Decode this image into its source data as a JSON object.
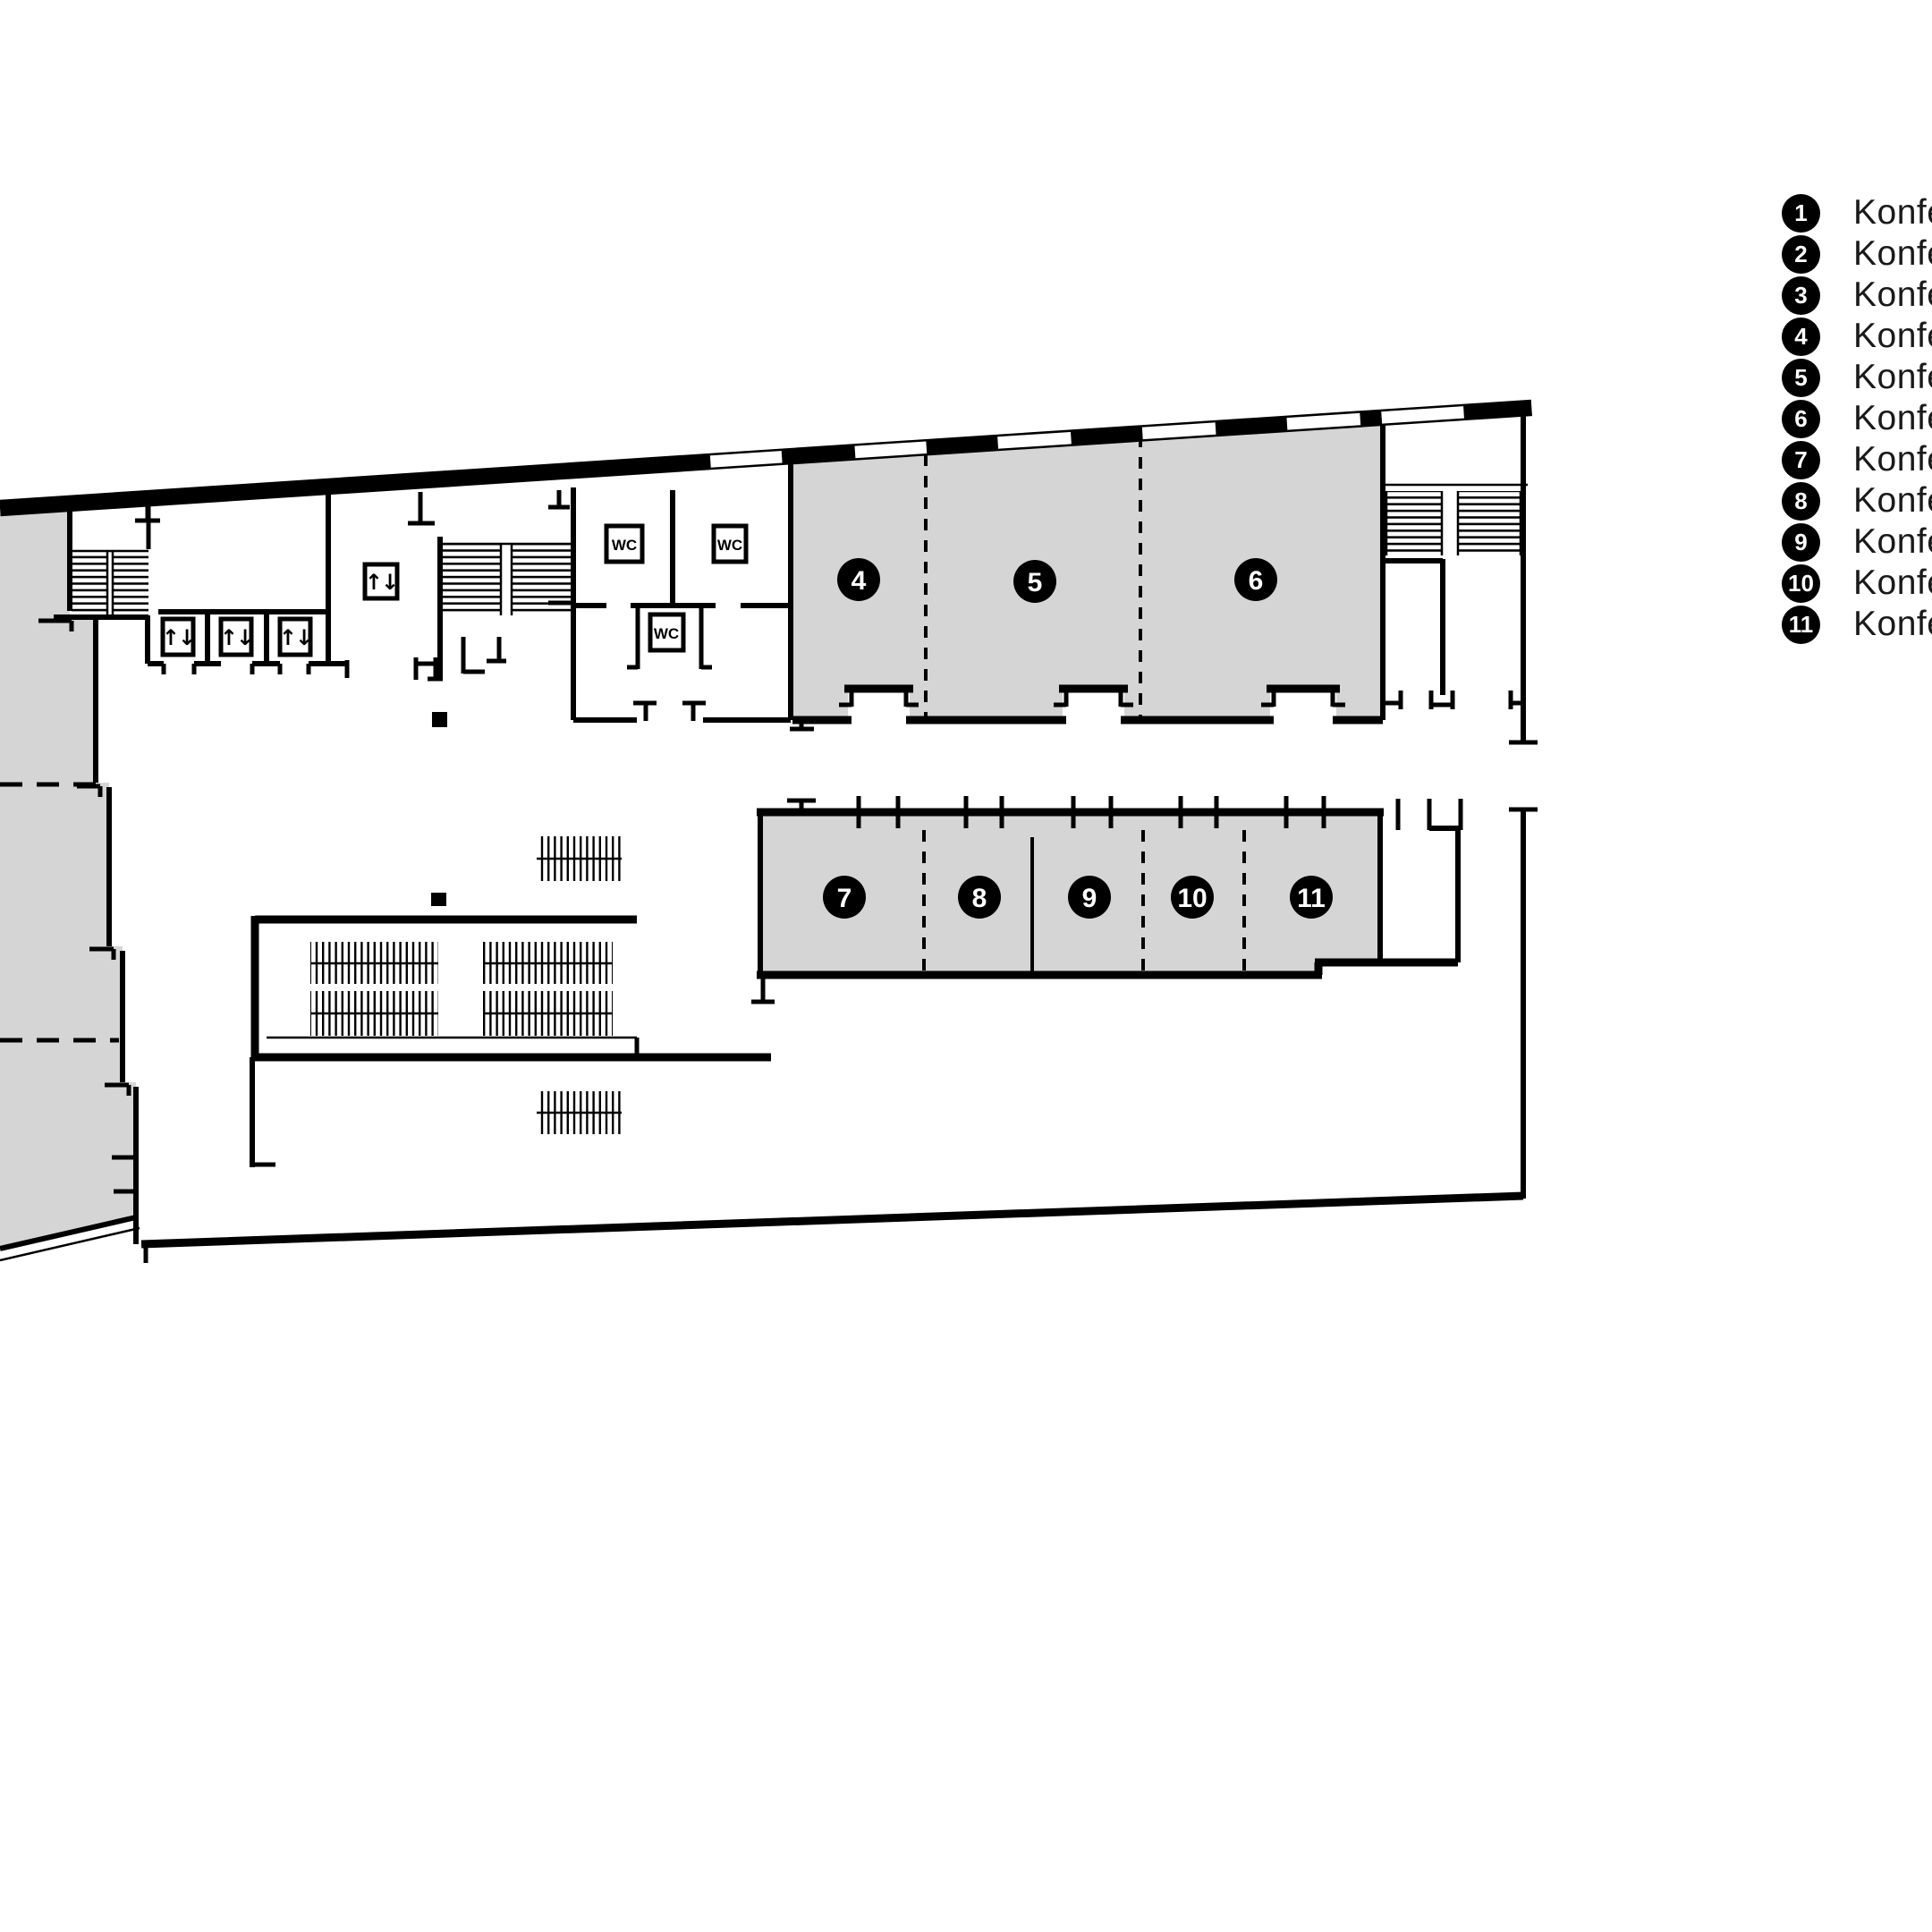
{
  "legend": {
    "items": [
      {
        "number": "1",
        "label": "Konferenzraum"
      },
      {
        "number": "2",
        "label": "Konferenzraum"
      },
      {
        "number": "3",
        "label": "Konferenzraum"
      },
      {
        "number": "4",
        "label": "Konferenzraum"
      },
      {
        "number": "5",
        "label": "Konferenzraum"
      },
      {
        "number": "6",
        "label": "Konferenzraum"
      },
      {
        "number": "7",
        "label": "Konferenzraum"
      },
      {
        "number": "8",
        "label": "Konferenzraum"
      },
      {
        "number": "9",
        "label": "Konferenzraum"
      },
      {
        "number": "10",
        "label": "Konferenzraum"
      },
      {
        "number": "11",
        "label": "Konferenzraum"
      }
    ]
  },
  "plan": {
    "badges": [
      {
        "number": "4"
      },
      {
        "number": "5"
      },
      {
        "number": "6"
      },
      {
        "number": "7"
      },
      {
        "number": "8"
      },
      {
        "number": "9"
      },
      {
        "number": "10"
      },
      {
        "number": "11"
      }
    ],
    "wc_label": "WC",
    "elevator_icon": "↑↓"
  },
  "colors": {
    "room_fill": "#d5d5d5",
    "wall": "#000000",
    "text": "#1a1a1a"
  }
}
